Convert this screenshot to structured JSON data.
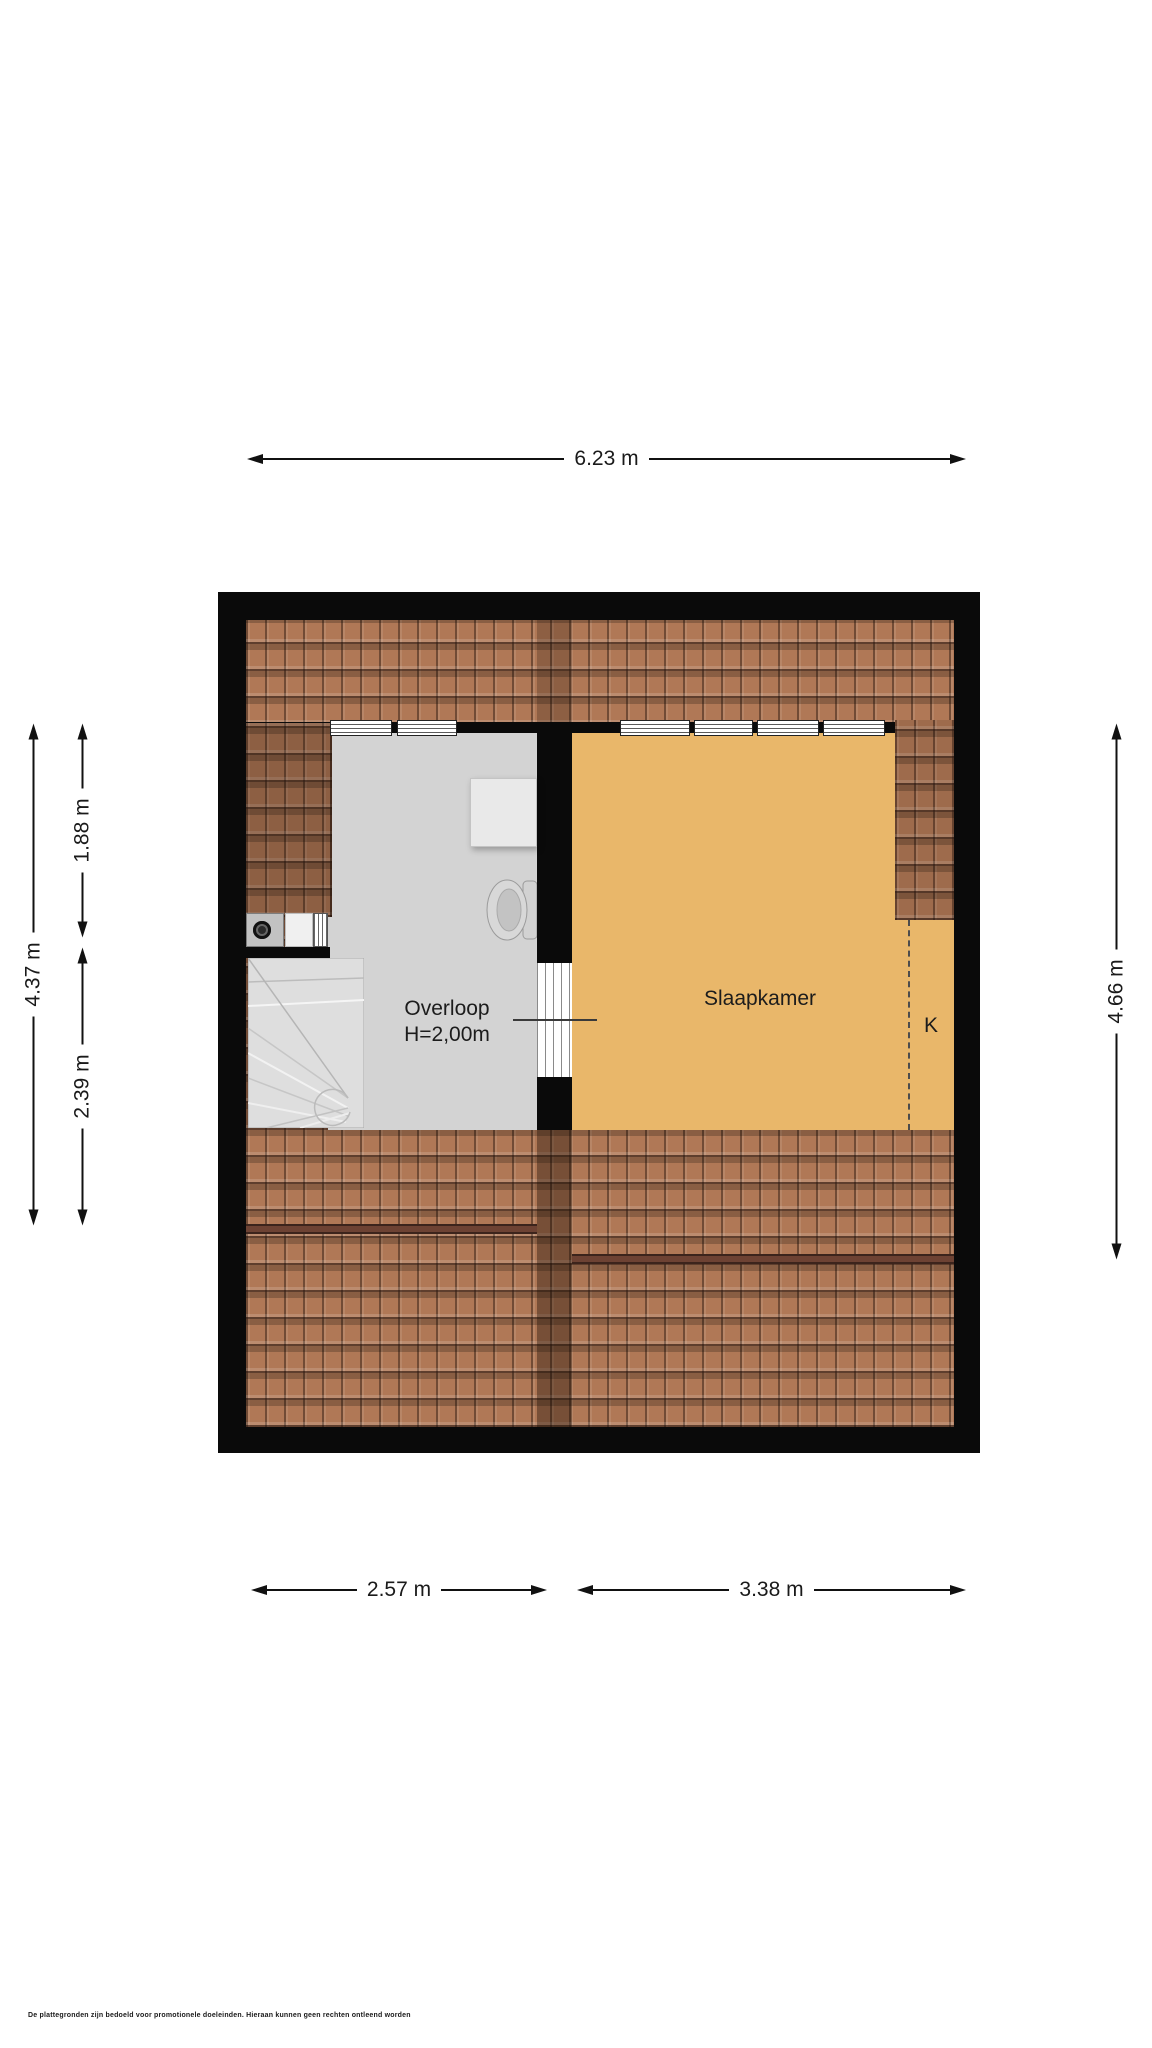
{
  "plan_title": "attic-floorplan",
  "rooms": {
    "overloop": {
      "label": "Overloop",
      "height_note": "H=2,00m"
    },
    "slaapkamer": {
      "label": "Slaapkamer"
    },
    "k": {
      "label": "K"
    }
  },
  "dims": {
    "top": "6.23 m",
    "bottom_left": "2.57 m",
    "bottom_right": "3.38 m",
    "left_outer": "4.37 m",
    "left_upper": "1.88 m",
    "left_lower": "2.39 m",
    "right": "4.66 m"
  },
  "footer": {
    "disclaimer": "De plattegronden zijn bedoeld voor promotionele doeleinden. Hieraan kunnen geen rechten ontleend worden"
  },
  "colors": {
    "wall": "#0a0a0a",
    "roof_tile": "#b07856",
    "roof_ridge": "#6d4233",
    "overloop_floor": "#d3d3d3",
    "slaapkamer_floor": "#e9b76a",
    "background": "#ffffff",
    "dimension_ink": "#111111"
  }
}
